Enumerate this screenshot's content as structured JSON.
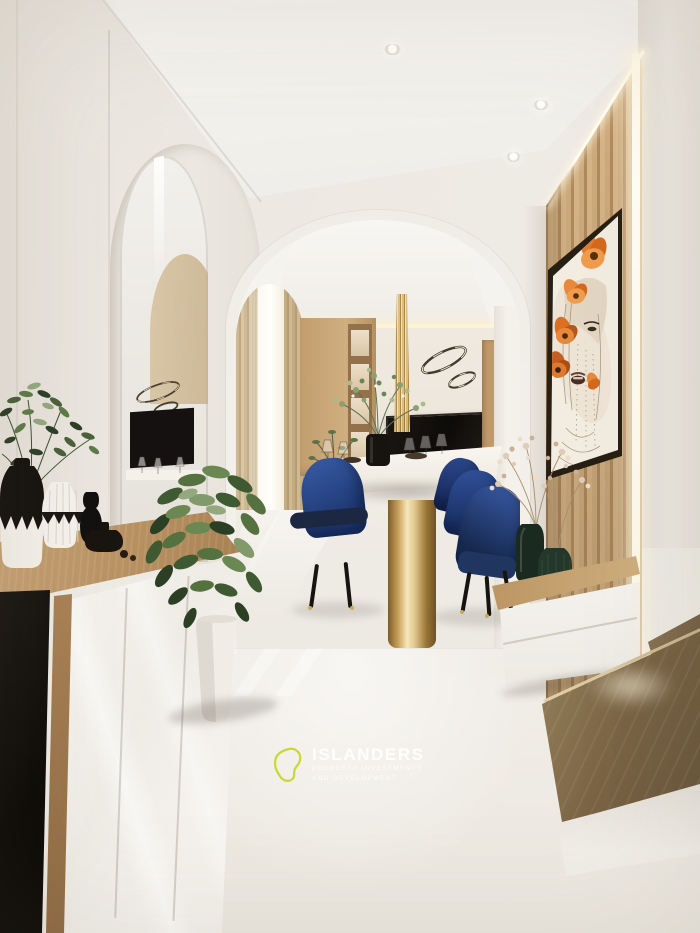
{
  "watermark": {
    "brand": "ISLANDERS",
    "tagline_line1": "PROPERTY INVESTMENTS",
    "tagline_line2": "AND DEVELOPMENT"
  },
  "palette": {
    "wall": "#ebe7e0",
    "ceiling": "#f3f1ec",
    "wood_slats": "#c7a476",
    "step_wood": "#7d6747",
    "floor": "#ede9e2",
    "chair_navy": "#24418a",
    "table_gold": "#c9a85c",
    "artwork_orange": "#df7a2e",
    "foliage_green": "#46603a",
    "bottle_green": "#1d2b22",
    "logo_lime": "#c9d932",
    "watermark_text": "#ffffff"
  }
}
